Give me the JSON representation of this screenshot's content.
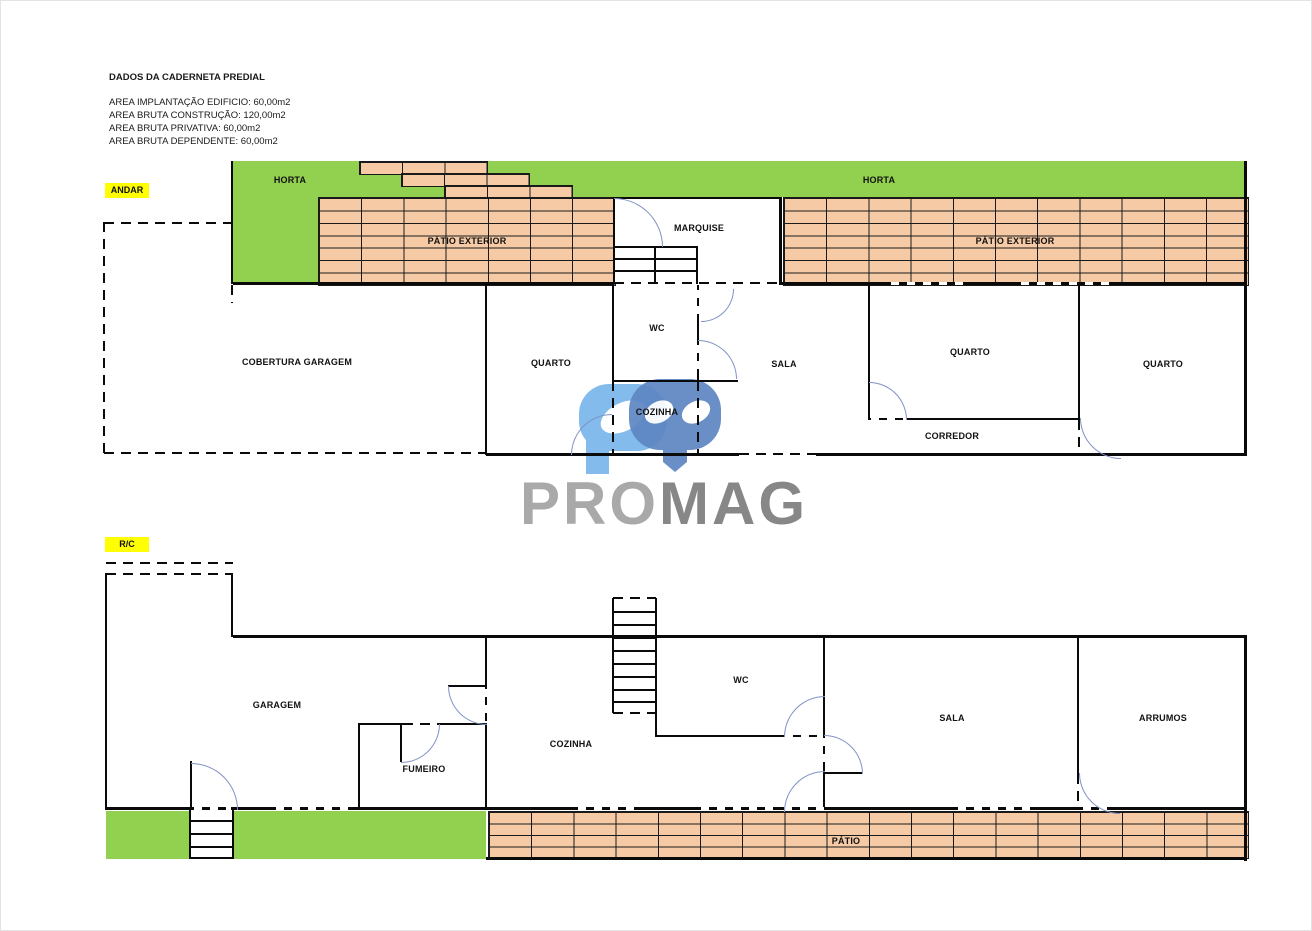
{
  "header": {
    "title": "DADOS DA CADERNETA PREDIAL",
    "line1": "AREA IMPLANTAÇÃO EDIFICIO: 60,00m2",
    "line2": "AREA BRUTA CONSTRUÇÃO: 120,00m2",
    "line3": "AREA BRUTA PRIVATIVA: 60,00m2",
    "line4": "AREA BRUTA DEPENDENTE: 60,00m2"
  },
  "andar": {
    "tag": "ANDAR",
    "horta_left": "HORTA",
    "horta_right": "HORTA",
    "patio_exterior_left": "PÁTIO EXTERIOR",
    "patio_exterior_right": "PÁTIO EXTERIOR",
    "marquise": "MARQUISE",
    "cobertura_garagem": "COBERTURA GARAGEM",
    "quarto_1": "QUARTO",
    "wc": "WC",
    "cozinha": "COZINHA",
    "sala": "SALA",
    "quarto_2": "QUARTO",
    "corredor": "CORREDOR",
    "quarto_3": "QUARTO"
  },
  "rc": {
    "tag": "R/C",
    "garagem": "GARAGEM",
    "fumeiro": "FUMEIRO",
    "cozinha": "COZINHA",
    "wc": "WC",
    "sala": "SALA",
    "arrumos": "ARRUMOS",
    "patio": "PÁTIO"
  },
  "logo": {
    "pro": "PRO",
    "mag": "MAG"
  },
  "colors": {
    "grass_green": "#92d050",
    "tile_salmon": "#f5caa5",
    "highlight_yellow": "#ffff00",
    "door_arc_blue": "#8193c4",
    "logo_light_blue": "#7db8ec",
    "logo_steel_blue": "#5e86c2",
    "logo_text_gray_light": "#a9a9a9",
    "logo_text_gray_dark": "#878787"
  }
}
